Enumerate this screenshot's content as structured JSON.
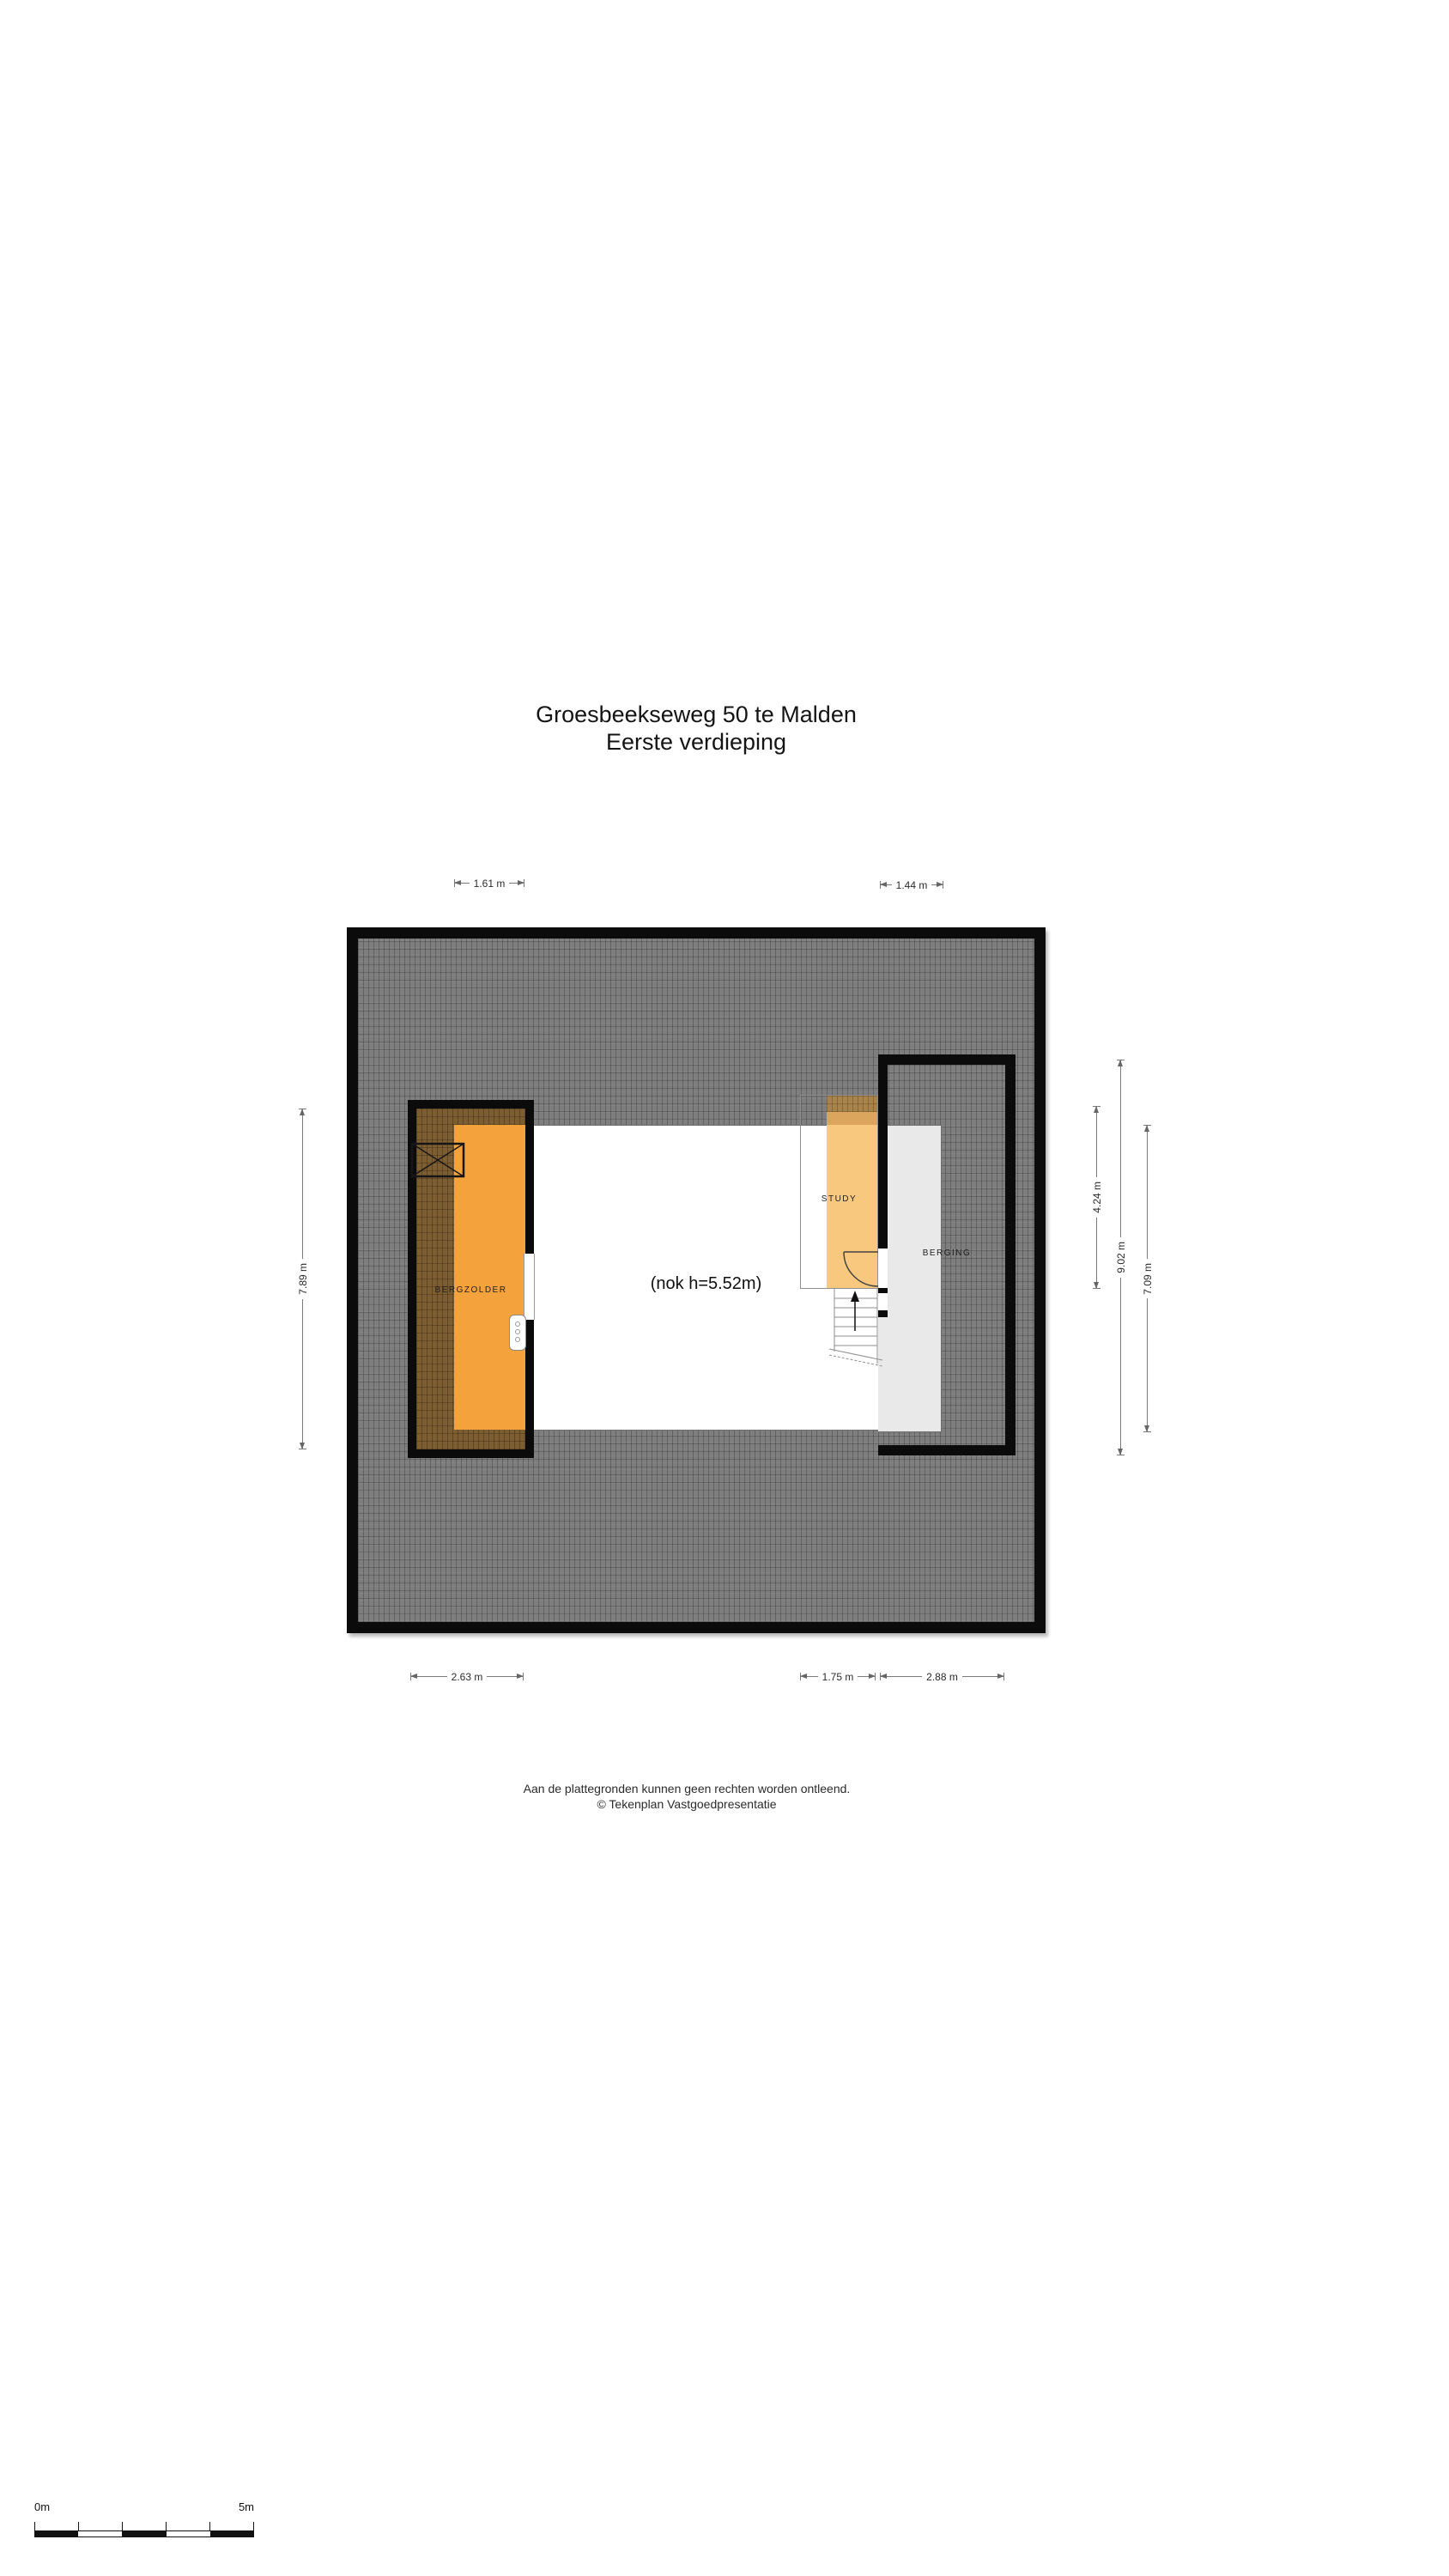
{
  "title": {
    "address": "Groesbeekseweg 50 te Malden",
    "floor": "Eerste verdieping"
  },
  "plan": {
    "ridge_note": "(nok h=5.52m)",
    "rooms": [
      {
        "name": "BERGZOLDER"
      },
      {
        "name": "STUDY"
      },
      {
        "name": "BERGING"
      }
    ]
  },
  "dimensions": {
    "top": [
      {
        "label": "1.61 m"
      },
      {
        "label": "1.44 m"
      }
    ],
    "bottom": [
      {
        "label": "2.63 m"
      },
      {
        "label": "1.75 m"
      },
      {
        "label": "2.88 m"
      }
    ],
    "left": [
      {
        "label": "7.89 m"
      }
    ],
    "right": [
      {
        "label": "4.24 m"
      },
      {
        "label": "9.02 m"
      },
      {
        "label": "7.09 m"
      }
    ]
  },
  "footer": {
    "disclaimer": "Aan de plattegronden kunnen geen rechten worden ontleend.",
    "copyright": "© Tekenplan Vastgoedpresentatie"
  },
  "scale_bar": {
    "start_label": "0m",
    "end_label": "5m"
  },
  "symbols": {
    "stairs_direction": "up-arrow",
    "void_marker": "x-cross",
    "door": "quarter-arc-swing"
  },
  "colors": {
    "wall": "#0b0b0b",
    "roof_hatch_base": "#7e7e7e",
    "under_roof_hatch": "#7d5e33",
    "bergzolder_floor": "#f4a23b",
    "study_floor": "#f8c87e",
    "berging_floor": "#e9e9e9",
    "dimension_line": "#7a7a7a"
  }
}
